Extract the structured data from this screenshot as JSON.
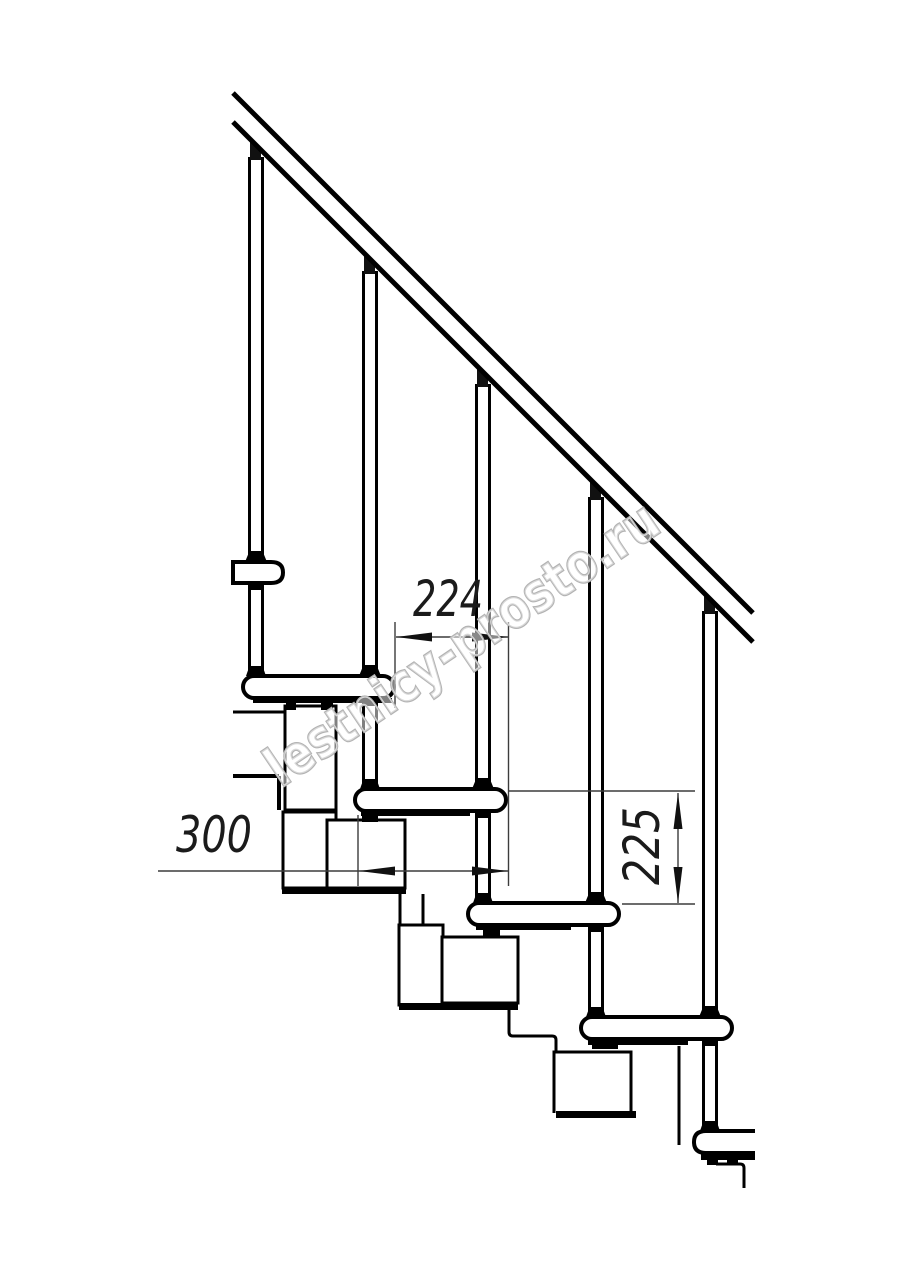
{
  "watermark": {
    "text": "lestnicy-prosto.ru",
    "outline_color": "#b3b3b3",
    "fill_color": "rgba(255,255,255,0.5)"
  },
  "dimensions": {
    "step_run": {
      "value": "224"
    },
    "tread_depth": {
      "value": "300"
    },
    "riser_height": {
      "value": "225"
    }
  },
  "drawing": {
    "ink_color": "#000000",
    "dim_color": "#3c3c3c",
    "arrow_color": "#111111",
    "shapes": [
      {
        "t": "rect",
        "x": 285,
        "y": 706,
        "wd": 51,
        "h": 104,
        "w": 3,
        "f": "#fff",
        "name": "stringer-module-1-upper-box"
      },
      {
        "t": "rect",
        "x": 283,
        "y": 812,
        "wd": 53,
        "h": 76,
        "w": 3,
        "f": "#fff",
        "name": "stringer-module-1-lower-box"
      },
      {
        "t": "rect",
        "x": 327,
        "y": 820,
        "wd": 78,
        "h": 68,
        "w": 3,
        "f": "#fff",
        "name": "stringer-module-2-box"
      },
      {
        "t": "rect",
        "x": 282,
        "y": 887,
        "wd": 124,
        "h": 7,
        "w": 0,
        "f": "#000",
        "name": "stringer-module-2-bottom-plate"
      },
      {
        "t": "line",
        "x1": 400,
        "y1": 894,
        "x2": 400,
        "y2": 926,
        "w": 3,
        "name": "module-2-3-connector-left-edge"
      },
      {
        "t": "line",
        "x1": 423,
        "y1": 894,
        "x2": 423,
        "y2": 926,
        "w": 3,
        "name": "module-2-3-connector-right-edge"
      },
      {
        "t": "rect",
        "x": 399,
        "y": 925,
        "wd": 44,
        "h": 80,
        "w": 3,
        "f": "#fff",
        "name": "stringer-module-3-hanger-box"
      },
      {
        "t": "rect",
        "x": 442,
        "y": 937,
        "wd": 76,
        "h": 66,
        "w": 3,
        "f": "#fff",
        "name": "stringer-module-3-box"
      },
      {
        "t": "rect",
        "x": 399,
        "y": 1003,
        "wd": 119,
        "h": 7,
        "w": 0,
        "f": "#000",
        "name": "stringer-module-3-bottom-plate"
      },
      {
        "t": "path",
        "d": "M509,1010 L509,1032 Q509,1036 513,1036 L552,1036 Q556,1036 556,1040 L556,1052",
        "w": 3,
        "name": "module-3-4-connector"
      },
      {
        "t": "path",
        "d": "M554,1113 L554,1052 L631,1052 L631,1113",
        "w": 3,
        "f": "#fff",
        "name": "stringer-module-4-box"
      },
      {
        "t": "rect",
        "x": 556,
        "y": 1111,
        "wd": 80,
        "h": 7,
        "w": 0,
        "f": "#000",
        "name": "stringer-module-4-bottom-plate"
      },
      {
        "t": "line",
        "x1": 679,
        "y1": 1046,
        "x2": 679,
        "y2": 1145,
        "w": 3,
        "name": "module-5-hanger-edge"
      },
      {
        "t": "path",
        "d": "M716,1164 L740,1164 Q744,1164 744,1168 L744,1188",
        "w": 3,
        "name": "module-5-lower-fragment"
      },
      {
        "t": "line",
        "x1": 233,
        "y1": 712,
        "x2": 284,
        "y2": 712,
        "w": 3,
        "name": "upper-flight-edge-line-1"
      },
      {
        "t": "line",
        "x1": 233,
        "y1": 776,
        "x2": 279,
        "y2": 776,
        "w": 4,
        "name": "upper-flight-edge-line-2"
      },
      {
        "t": "line",
        "x1": 279,
        "y1": 776,
        "x2": 279,
        "y2": 810,
        "w": 4,
        "name": "upper-flight-edge-line-3"
      },
      {
        "t": "line",
        "x1": 249.5,
        "y1": 157,
        "x2": 249.5,
        "y2": 676,
        "w": 3,
        "name": "baluster-1-rod-left"
      },
      {
        "t": "line",
        "x1": 262.5,
        "y1": 157,
        "x2": 262.5,
        "y2": 676,
        "w": 3,
        "name": "baluster-1-rod-right"
      },
      {
        "t": "line",
        "x1": 363.5,
        "y1": 271,
        "x2": 363.5,
        "y2": 789,
        "w": 3,
        "name": "baluster-2-rod-left"
      },
      {
        "t": "line",
        "x1": 376.5,
        "y1": 271,
        "x2": 376.5,
        "y2": 789,
        "w": 3,
        "name": "baluster-2-rod-right"
      },
      {
        "t": "line",
        "x1": 476.5,
        "y1": 384,
        "x2": 476.5,
        "y2": 903,
        "w": 3,
        "name": "baluster-3-rod-left"
      },
      {
        "t": "line",
        "x1": 489.5,
        "y1": 384,
        "x2": 489.5,
        "y2": 903,
        "w": 3,
        "name": "baluster-3-rod-right"
      },
      {
        "t": "line",
        "x1": 589.5,
        "y1": 497,
        "x2": 589.5,
        "y2": 1017,
        "w": 3,
        "name": "baluster-4-rod-left"
      },
      {
        "t": "line",
        "x1": 602.5,
        "y1": 497,
        "x2": 602.5,
        "y2": 1017,
        "w": 3,
        "name": "baluster-4-rod-right"
      },
      {
        "t": "line",
        "x1": 703.5,
        "y1": 611,
        "x2": 703.5,
        "y2": 1131,
        "w": 3,
        "name": "baluster-5-rod-left"
      },
      {
        "t": "line",
        "x1": 716.5,
        "y1": 611,
        "x2": 716.5,
        "y2": 1131,
        "w": 3,
        "name": "baluster-5-rod-right"
      },
      {
        "t": "path",
        "d": "M233,562 L271,562 Q283,562 283,572.5 Q283,583 271,583 L233,583 Z",
        "w": 4,
        "f": "#fff",
        "name": "upper-flight-step-end-view"
      },
      {
        "t": "rect",
        "x": 243,
        "y": 676,
        "wd": 151,
        "h": 22,
        "rx": 11,
        "w": 4,
        "f": "#fff",
        "name": "step-1-tread"
      },
      {
        "t": "rect",
        "x": 355,
        "y": 789,
        "wd": 151,
        "h": 22,
        "rx": 11,
        "w": 4,
        "f": "#fff",
        "name": "step-2-tread"
      },
      {
        "t": "rect",
        "x": 468,
        "y": 903,
        "wd": 151,
        "h": 22,
        "rx": 11,
        "w": 4,
        "f": "#fff",
        "name": "step-3-tread"
      },
      {
        "t": "rect",
        "x": 581,
        "y": 1017,
        "wd": 151,
        "h": 22,
        "rx": 11,
        "w": 4,
        "f": "#fff",
        "name": "step-4-tread"
      },
      {
        "t": "path",
        "d": "M755,1131 L706,1131 Q694,1131 694,1142 Q694,1153 706,1153 L755,1153",
        "w": 4,
        "f": "#fff",
        "name": "step-5-tread-partial"
      },
      {
        "t": "rect",
        "x": 253,
        "y": 698,
        "wd": 139,
        "h": 5,
        "w": 0,
        "f": "#000",
        "name": "step-1-underside-plate"
      },
      {
        "t": "rect",
        "x": 361,
        "y": 811,
        "wd": 109,
        "h": 5,
        "w": 0,
        "f": "#000",
        "name": "step-2-underside-plate"
      },
      {
        "t": "rect",
        "x": 476,
        "y": 925,
        "wd": 95,
        "h": 5,
        "w": 0,
        "f": "#000",
        "name": "step-3-underside-plate"
      },
      {
        "t": "rect",
        "x": 588,
        "y": 1039,
        "wd": 100,
        "h": 6,
        "w": 0,
        "f": "#000",
        "name": "step-4-underside-plate"
      },
      {
        "t": "rect",
        "x": 701,
        "y": 1152,
        "wd": 54,
        "h": 8,
        "w": 0,
        "f": "#000",
        "name": "step-5-underside-plate"
      },
      {
        "t": "rect",
        "x": 707,
        "y": 1160,
        "wd": 11,
        "h": 5,
        "w": 0,
        "f": "#000",
        "name": "step-5-mount-tab-a"
      },
      {
        "t": "rect",
        "x": 727,
        "y": 1160,
        "wd": 11,
        "h": 5,
        "w": 0,
        "f": "#000",
        "name": "step-5-mount-tab-b"
      },
      {
        "t": "rect",
        "x": 286,
        "y": 703,
        "wd": 10,
        "h": 7,
        "w": 0,
        "f": "#000",
        "name": "step-1-mount-tab-a"
      },
      {
        "t": "rect",
        "x": 321,
        "y": 703,
        "wd": 12,
        "h": 7,
        "w": 0,
        "f": "#000",
        "name": "step-1-mount-tab-b"
      },
      {
        "t": "rect",
        "x": 362,
        "y": 816,
        "wd": 16,
        "h": 6,
        "w": 0,
        "f": "#000",
        "name": "step-2-mount-tab"
      },
      {
        "t": "rect",
        "x": 483,
        "y": 930,
        "wd": 17,
        "h": 6,
        "w": 0,
        "f": "#000",
        "name": "step-3-mount-tab"
      },
      {
        "t": "rect",
        "x": 592,
        "y": 1044,
        "wd": 26,
        "h": 5,
        "w": 0,
        "f": "#000",
        "name": "step-4-mount-tab"
      },
      {
        "t": "poly",
        "p": "250,142 261,153 261,160 250,160",
        "f": "#111",
        "name": "baluster-1-rail-cap"
      },
      {
        "t": "poly",
        "p": "364,256 375,267 375,274 364,274",
        "f": "#111",
        "name": "baluster-2-rail-cap"
      },
      {
        "t": "poly",
        "p": "477,369 488,380 488,387 477,387",
        "f": "#111",
        "name": "baluster-3-rail-cap"
      },
      {
        "t": "poly",
        "p": "590,482 601,493 601,500 590,500",
        "f": "#111",
        "name": "baluster-4-rail-cap"
      },
      {
        "t": "poly",
        "p": "704,596 715,607 715,614 704,614",
        "f": "#111",
        "name": "baluster-5-rail-cap"
      },
      {
        "t": "poly",
        "p": "249.5,551 262.5,551 267,562 245,562",
        "f": "#000",
        "name": "baluster-1-pass-collar"
      },
      {
        "t": "poly",
        "p": "363.5,665 376.5,665 381,676 359,676",
        "f": "#000",
        "name": "baluster-2-pass-collar"
      },
      {
        "t": "poly",
        "p": "476.5,778 489.5,778 494,789 472,789",
        "f": "#000",
        "name": "baluster-3-pass-collar"
      },
      {
        "t": "poly",
        "p": "589.5,892 602.5,892 607,903 585,903",
        "f": "#000",
        "name": "baluster-4-pass-collar"
      },
      {
        "t": "poly",
        "p": "703.5,1006 716.5,1006 721,1017 699,1017",
        "f": "#000",
        "name": "baluster-5-pass-collar"
      },
      {
        "t": "rect",
        "x": 248,
        "y": 584,
        "wd": 16,
        "h": 6,
        "w": 0,
        "f": "#000",
        "name": "baluster-1-under-flange"
      },
      {
        "t": "rect",
        "x": 362,
        "y": 699,
        "wd": 16,
        "h": 7,
        "w": 0,
        "f": "#000",
        "name": "baluster-2-under-flange"
      },
      {
        "t": "rect",
        "x": 475,
        "y": 812,
        "wd": 16,
        "h": 6,
        "w": 0,
        "f": "#000",
        "name": "baluster-3-under-flange"
      },
      {
        "t": "rect",
        "x": 588,
        "y": 926,
        "wd": 16,
        "h": 6,
        "w": 0,
        "f": "#000",
        "name": "baluster-4-under-flange"
      },
      {
        "t": "rect",
        "x": 702,
        "y": 1040,
        "wd": 16,
        "h": 6,
        "w": 0,
        "f": "#000",
        "name": "baluster-5-under-flange"
      },
      {
        "t": "poly",
        "p": "249.5,666 262.5,666 266,676 246,676",
        "f": "#000",
        "name": "baluster-1-base-flange"
      },
      {
        "t": "poly",
        "p": "363.5,779 376.5,779 380,789 360,789",
        "f": "#000",
        "name": "baluster-2-base-flange"
      },
      {
        "t": "poly",
        "p": "476.5,893 489.5,893 493,903 473,903",
        "f": "#000",
        "name": "baluster-3-base-flange"
      },
      {
        "t": "poly",
        "p": "589.5,1007 602.5,1007 606,1017 586,1017",
        "f": "#000",
        "name": "baluster-4-base-flange"
      },
      {
        "t": "poly",
        "p": "703.5,1121 716.5,1121 720,1131 700,1131",
        "f": "#000",
        "name": "baluster-5-base-flange"
      },
      {
        "t": "line",
        "x1": 233,
        "y1": 93,
        "x2": 753,
        "y2": 613,
        "w": 5,
        "name": "handrail-upper-line"
      },
      {
        "t": "line",
        "x1": 233,
        "y1": 122,
        "x2": 753,
        "y2": 642,
        "w": 5,
        "name": "handrail-lower-line"
      },
      {
        "t": "line",
        "x1": 395,
        "y1": 622,
        "x2": 395,
        "y2": 708,
        "w": 1.4,
        "c": "#3c3c3c",
        "name": "dim-224-extension-left"
      },
      {
        "t": "line",
        "x1": 508.5,
        "y1": 622,
        "x2": 508.5,
        "y2": 886,
        "w": 1.4,
        "c": "#3c3c3c",
        "name": "dim-224-300-extension-right"
      },
      {
        "t": "line",
        "x1": 358,
        "y1": 815,
        "x2": 358,
        "y2": 886,
        "w": 1.4,
        "c": "#3c3c3c",
        "name": "dim-300-extension-left"
      },
      {
        "t": "line",
        "x1": 508,
        "y1": 791,
        "x2": 695,
        "y2": 791,
        "w": 1.4,
        "c": "#3c3c3c",
        "name": "dim-225-extension-top"
      },
      {
        "t": "line",
        "x1": 622,
        "y1": 904,
        "x2": 695,
        "y2": 904,
        "w": 1.4,
        "c": "#3c3c3c",
        "name": "dim-225-extension-bottom"
      },
      {
        "t": "line",
        "x1": 396,
        "y1": 637,
        "x2": 508,
        "y2": 637,
        "w": 1.4,
        "c": "#3c3c3c",
        "name": "dim-224-line"
      },
      {
        "t": "line",
        "x1": 158,
        "y1": 871,
        "x2": 508,
        "y2": 871,
        "w": 1.4,
        "c": "#3c3c3c",
        "name": "dim-300-line"
      },
      {
        "t": "line",
        "x1": 678,
        "y1": 793,
        "x2": 678,
        "y2": 903,
        "w": 1.4,
        "c": "#3c3c3c",
        "name": "dim-225-line"
      },
      {
        "t": "poly",
        "p": "396,637 432,632.5 432,641.5",
        "f": "#111",
        "name": "dim-224-arrow-left"
      },
      {
        "t": "poly",
        "p": "508,637 472,632.5 472,641.5",
        "f": "#111",
        "name": "dim-224-arrow-right"
      },
      {
        "t": "poly",
        "p": "359,871 395,866.5 395,875.5",
        "f": "#111",
        "name": "dim-300-arrow-left"
      },
      {
        "t": "poly",
        "p": "508,871 472,866.5 472,875.5",
        "f": "#111",
        "name": "dim-300-arrow-right"
      },
      {
        "t": "poly",
        "p": "678,793 673.5,829 682.5,829",
        "f": "#111",
        "name": "dim-225-arrow-up"
      },
      {
        "t": "poly",
        "p": "678,903 673.5,867 682.5,867",
        "f": "#111",
        "name": "dim-225-arrow-down"
      }
    ]
  }
}
